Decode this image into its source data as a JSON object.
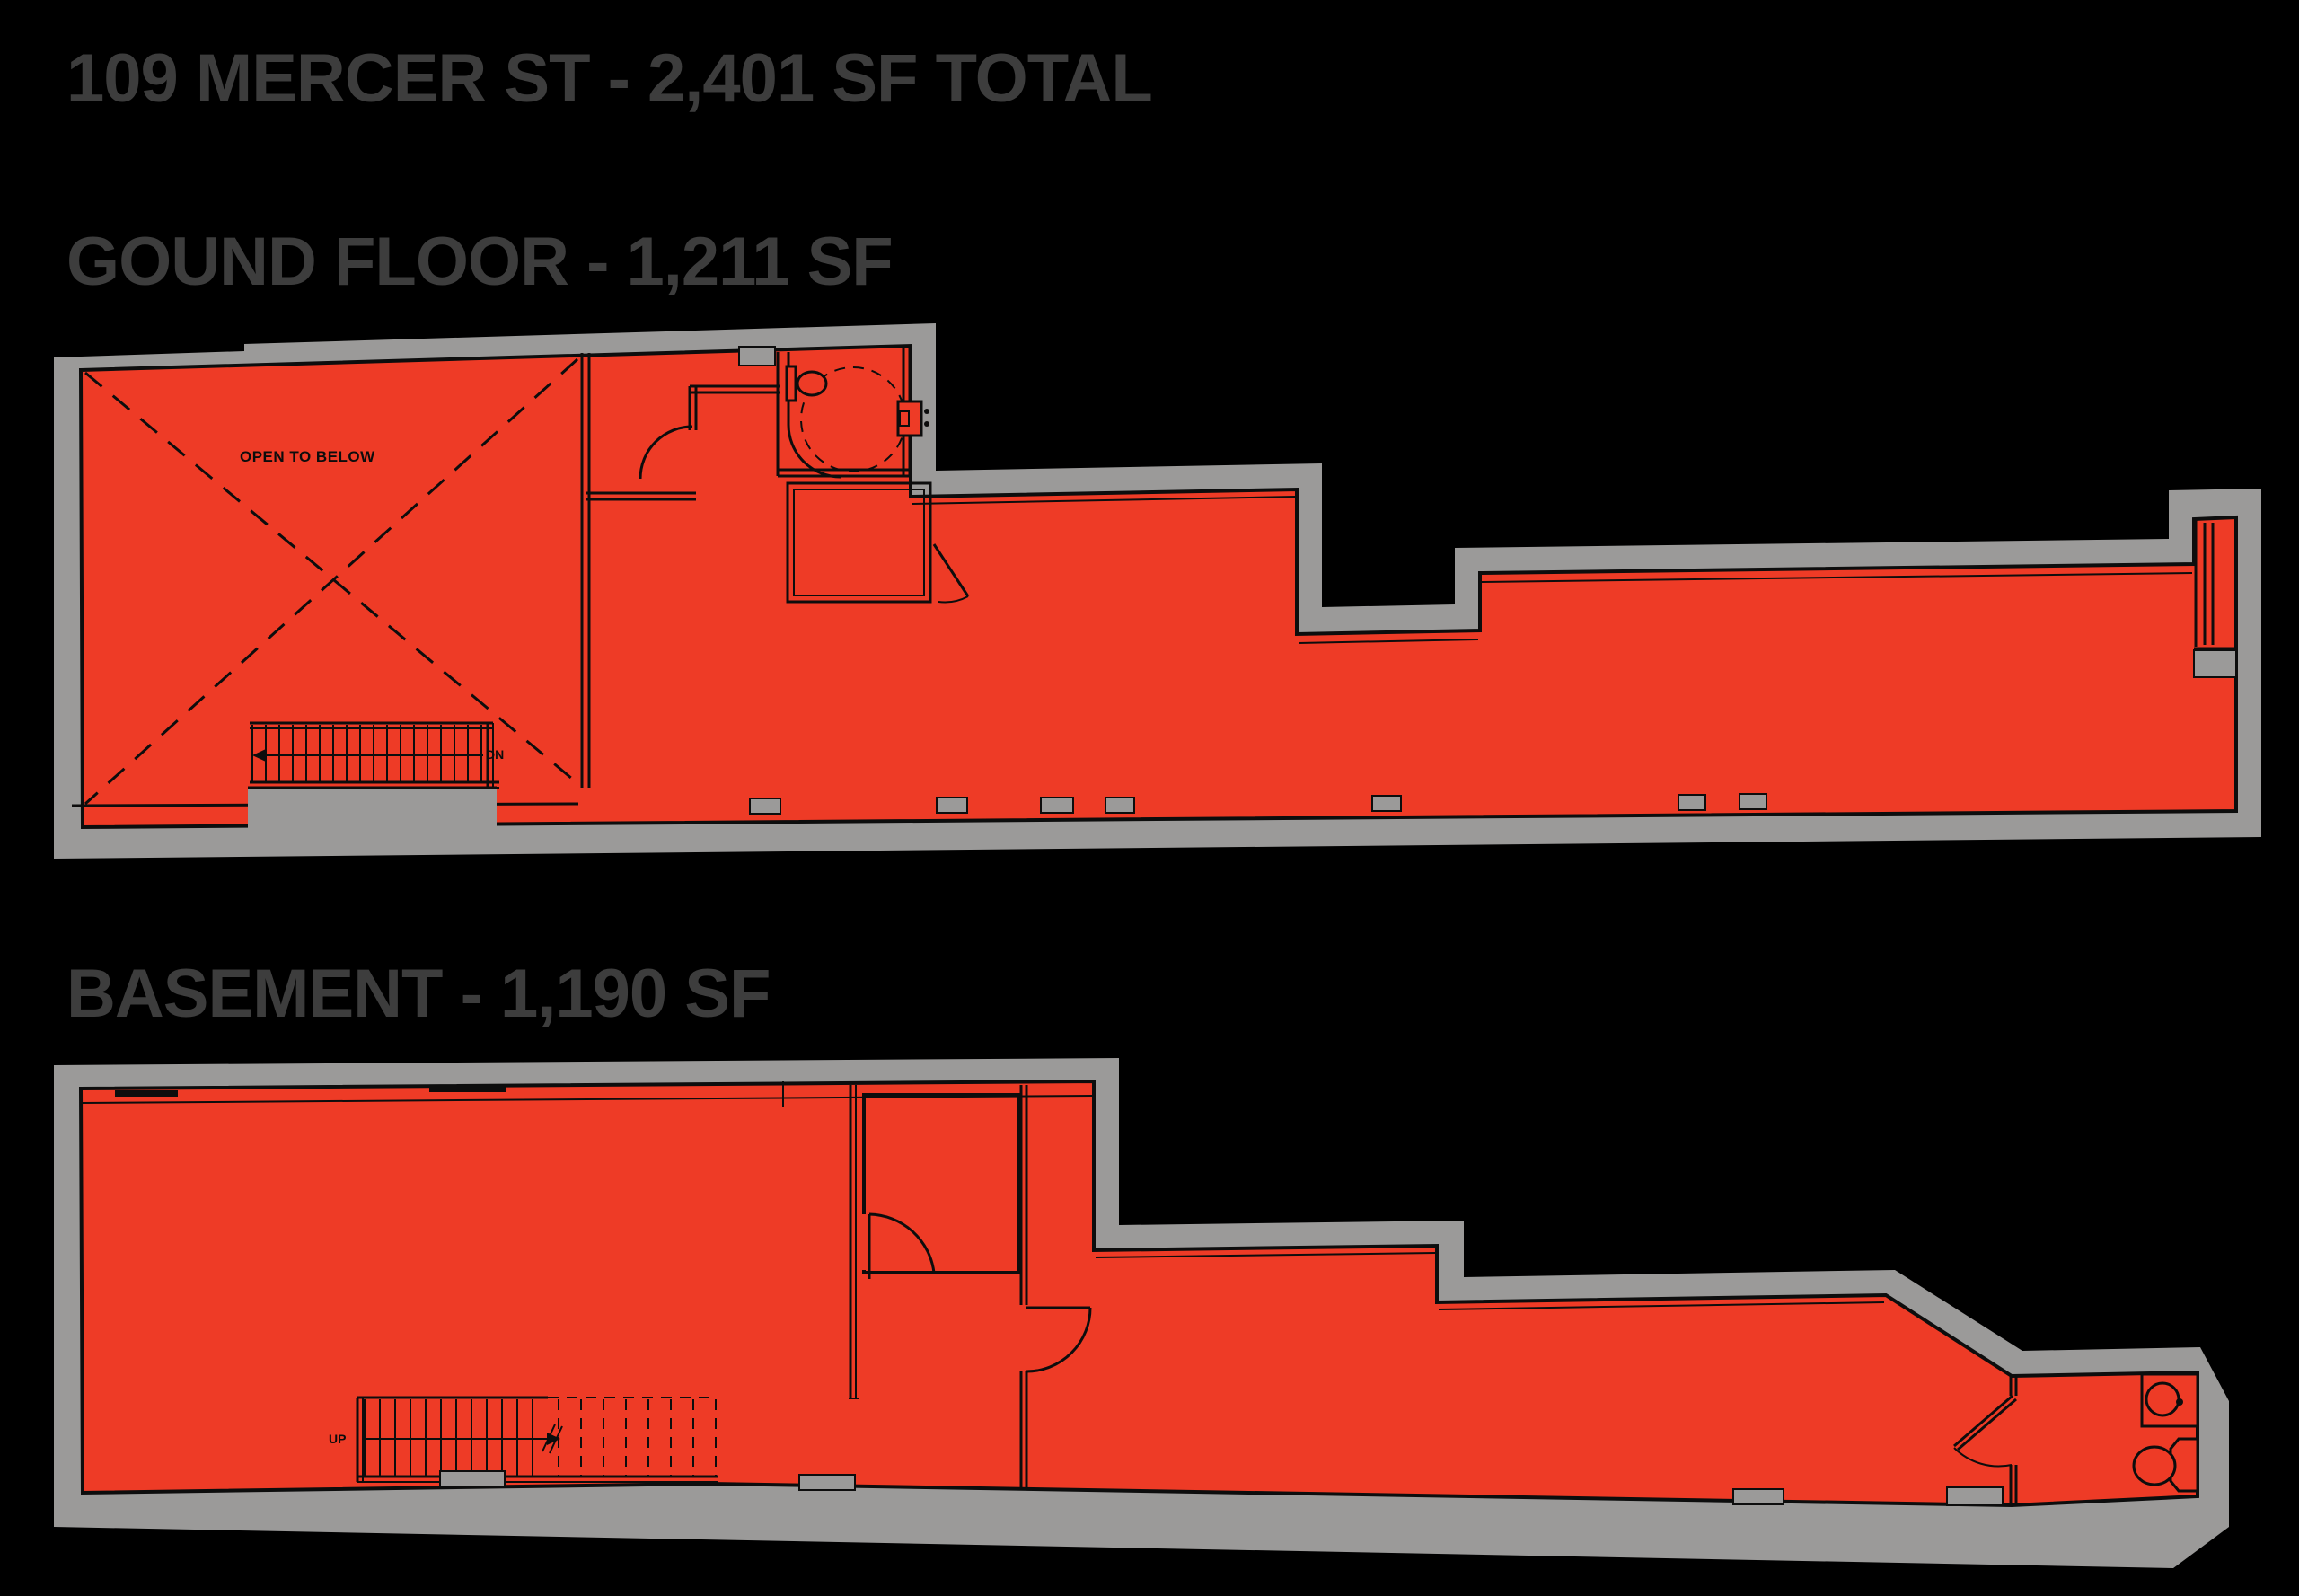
{
  "header": {
    "title": "109 MERCER ST - 2,401 SF TOTAL"
  },
  "floors": {
    "ground": {
      "title": "GOUND FLOOR - 1,211 SF",
      "annotations": {
        "open_to_below": "OPEN TO BELOW",
        "stair_direction": "DN"
      }
    },
    "basement": {
      "title": "BASEMENT - 1,190 SF",
      "annotations": {
        "stair_direction": "UP"
      }
    }
  },
  "colors": {
    "background": "#000000",
    "unit_fill_red": "#ee3b26",
    "wall_gray": "#9b9a99",
    "title_text_gray": "#3d3d3d",
    "plan_line": "#0d0d0d"
  }
}
